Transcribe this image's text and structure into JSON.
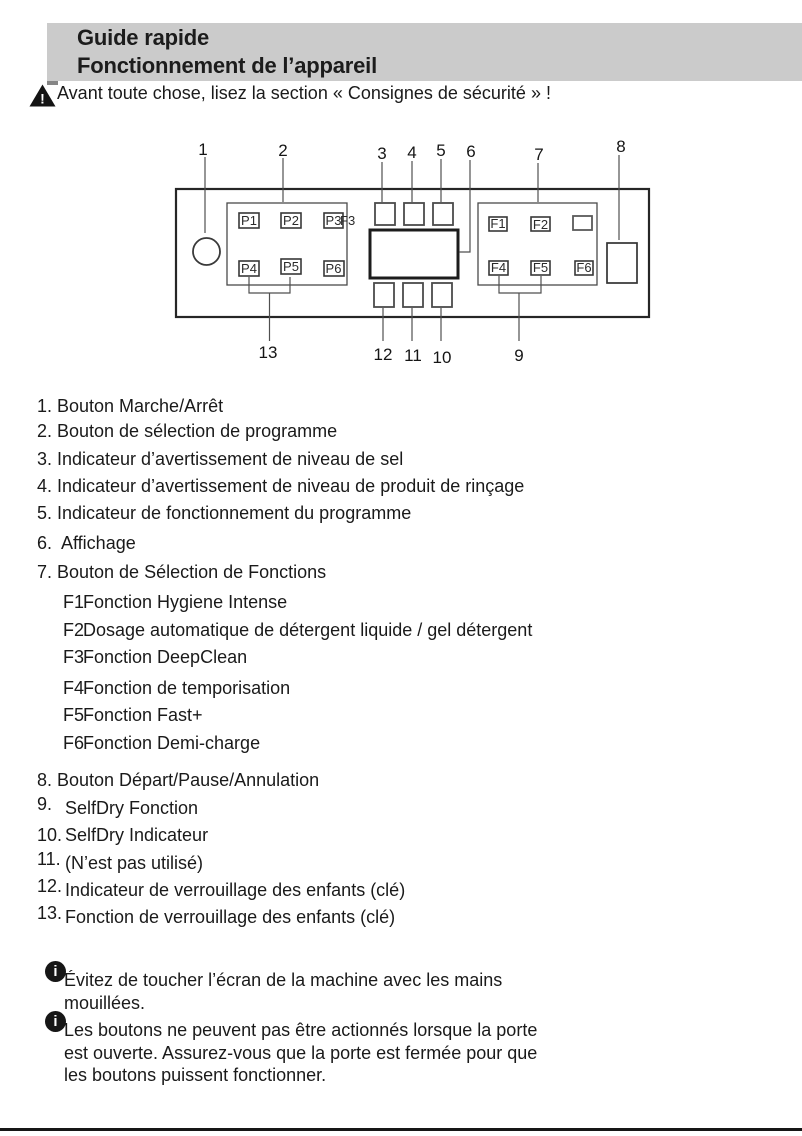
{
  "header": {
    "line1": "Guide rapide",
    "line2": "Fonctionnement de l’appareil"
  },
  "warning": {
    "text": "Avant toute chose, lisez la section « Consignes de sécurité » !"
  },
  "diagram": {
    "callouts": [
      "1",
      "2",
      "3",
      "4",
      "5",
      "6",
      "7",
      "8",
      "9",
      "10",
      "11",
      "12",
      "13"
    ],
    "program_buttons": [
      "P1",
      "P2",
      "P3",
      "P4",
      "P5",
      "P6"
    ],
    "function_buttons": [
      "F1",
      "F2",
      "F4",
      "F5",
      "F6"
    ],
    "stray_label": "F3"
  },
  "legend": {
    "items": [
      {
        "num": "1.",
        "text": "Bouton Marche/Arrêt"
      },
      {
        "num": "2.",
        "text": "Bouton de sélection de programme"
      },
      {
        "num": "3.",
        "text": "Indicateur d’avertissement de niveau de sel"
      },
      {
        "num": "4.",
        "text": "Indicateur d’avertissement de niveau de produit de rinçage"
      },
      {
        "num": "5.",
        "text": "Indicateur de fonctionnement du programme"
      },
      {
        "num": "6.",
        "text": "Affichage"
      },
      {
        "num": "7.",
        "text": "Bouton de Sélection de Fonctions"
      },
      {
        "num": "8.",
        "text": "Bouton Départ/Pause/Annulation"
      },
      {
        "num": "9.",
        "text": "SelfDry Fonction"
      },
      {
        "num": "10.",
        "text": "SelfDry Indicateur"
      },
      {
        "num": "11.",
        "text": "(N’est pas utilisé)"
      },
      {
        "num": "12.",
        "text": "Indicateur de verrouillage des enfants (clé)"
      },
      {
        "num": "13.",
        "text": "Fonction de verrouillage des enfants (clé)"
      }
    ]
  },
  "functions": [
    {
      "code": "F1",
      "text": "Fonction Hygiene Intense"
    },
    {
      "code": "F2",
      "text": "Dosage automatique de détergent liquide / gel détergent"
    },
    {
      "code": "F3",
      "text": "Fonction DeepClean"
    },
    {
      "code": "F4",
      "text": "Fonction de temporisation"
    },
    {
      "code": "F5",
      "text": "Fonction Fast+"
    },
    {
      "code": "F6",
      "text": "Fonction Demi-charge"
    }
  ],
  "notes": [
    {
      "text": "Évitez de toucher l’écran de la machine avec les mains mouillées."
    },
    {
      "text": "Les boutons ne peuvent pas être actionnés lorsque la porte est ouverte. Assurez-vous que la porte est fermée pour que les boutons puissent fonctionner."
    }
  ],
  "warning_glyph": "!",
  "info_glyph": "i",
  "colors": {
    "header_bg": "#cbcbcb",
    "text": "#1a1a1a"
  }
}
